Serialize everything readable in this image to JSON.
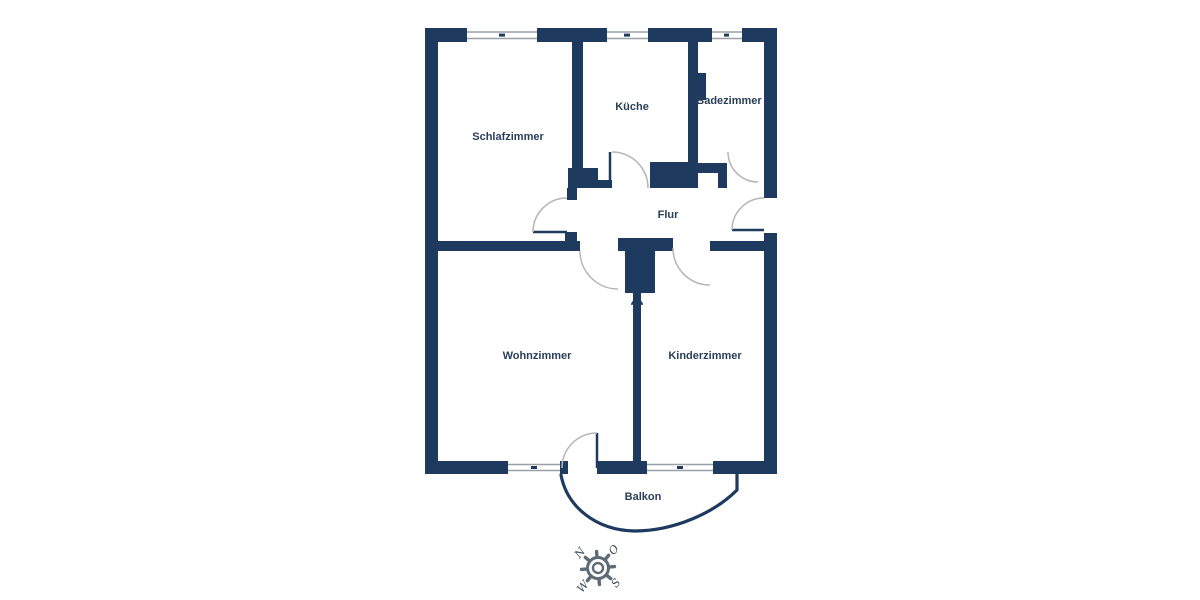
{
  "colors": {
    "wall": "#1e3a5f",
    "door_arc": "#b5b5b5",
    "window_line": "#9aa0a8",
    "label_text": "#2b3e58",
    "compass": "#5d6b77",
    "compass_letter": "#3d4a56",
    "background": "#ffffff"
  },
  "rooms": [
    {
      "id": "schlafzimmer",
      "label": "Schlafzimmer"
    },
    {
      "id": "kueche",
      "label": "Küche"
    },
    {
      "id": "badezimmer",
      "label": "Badezimmer"
    },
    {
      "id": "flur",
      "label": "Flur"
    },
    {
      "id": "wohnzimmer",
      "label": "Wohnzimmer"
    },
    {
      "id": "kinderzimmer",
      "label": "Kinderzimmer"
    },
    {
      "id": "balkon",
      "label": "Balkon"
    }
  ],
  "compass": {
    "north": "N",
    "east": "O",
    "south": "S",
    "west": "W"
  },
  "icons": {
    "compass": "compass-rose-icon",
    "entrance": "entrance-arrow-icon"
  }
}
